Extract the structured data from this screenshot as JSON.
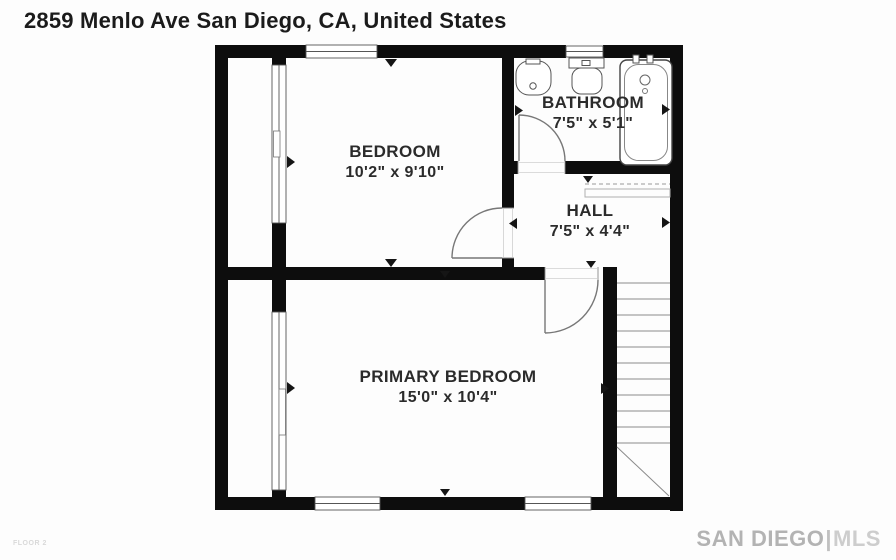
{
  "title": "2859 Menlo Ave San Diego, CA, United States",
  "floor_label": "FLOOR 2",
  "watermark": {
    "brand": "SAN DIEGO",
    "separator": "|",
    "suffix": "MLS"
  },
  "rooms": {
    "bedroom": {
      "name": "BEDROOM",
      "dimensions": "10'2\" x 9'10\""
    },
    "bathroom": {
      "name": "BATHROOM",
      "dimensions": "7'5\" x 5'1\""
    },
    "hall": {
      "name": "HALL",
      "dimensions": "7'5\" x 4'4\""
    },
    "primary_bedroom": {
      "name": "PRIMARY BEDROOM",
      "dimensions": "15'0\" x 10'4\""
    }
  },
  "icons": [
    "sink-icon",
    "toilet-icon",
    "bathtub-icon",
    "stairs-icon",
    "door-swing-icon",
    "window-icon",
    "wall-marker-icon"
  ],
  "colors": {
    "wall": "#0d0d0d",
    "fixture_line": "#666666",
    "label_text": "#2b2b2b",
    "watermark": "#b5b5b5"
  }
}
